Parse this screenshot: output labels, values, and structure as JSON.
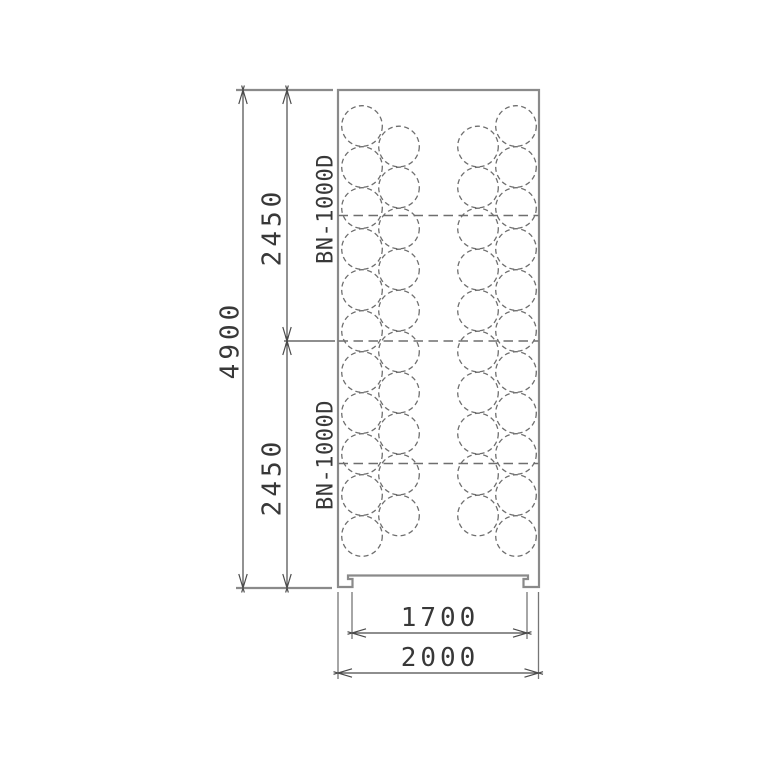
{
  "drawing": {
    "type": "plan-view-technical-drawing",
    "background": "#ffffff"
  },
  "colors": {
    "outline_gray": "#8a8a8a",
    "dashed_gray": "#6e6e6e",
    "dimension_dark": "#4a4a4a",
    "text": "#383838"
  },
  "units": [
    {
      "model": "BN-1000D"
    },
    {
      "model": "BN-1000D"
    }
  ],
  "dims": {
    "overall_height": "4900",
    "upper_unit_height": "2450",
    "lower_unit_height": "2450",
    "inner_width": "1700",
    "overall_width": "2000"
  },
  "plan_view": {
    "circle_radius": 20.3,
    "circle_pitch": 41,
    "columns": [
      {
        "x": 362,
        "start_y": 126,
        "count": 11
      },
      {
        "x": 399,
        "start_y": 146.5,
        "count": 10
      },
      {
        "x": 478,
        "start_y": 146.5,
        "count": 10
      },
      {
        "x": 516,
        "start_y": 126,
        "count": 11
      }
    ],
    "divider_ys": [
      215.5,
      341,
      463.5
    ]
  }
}
